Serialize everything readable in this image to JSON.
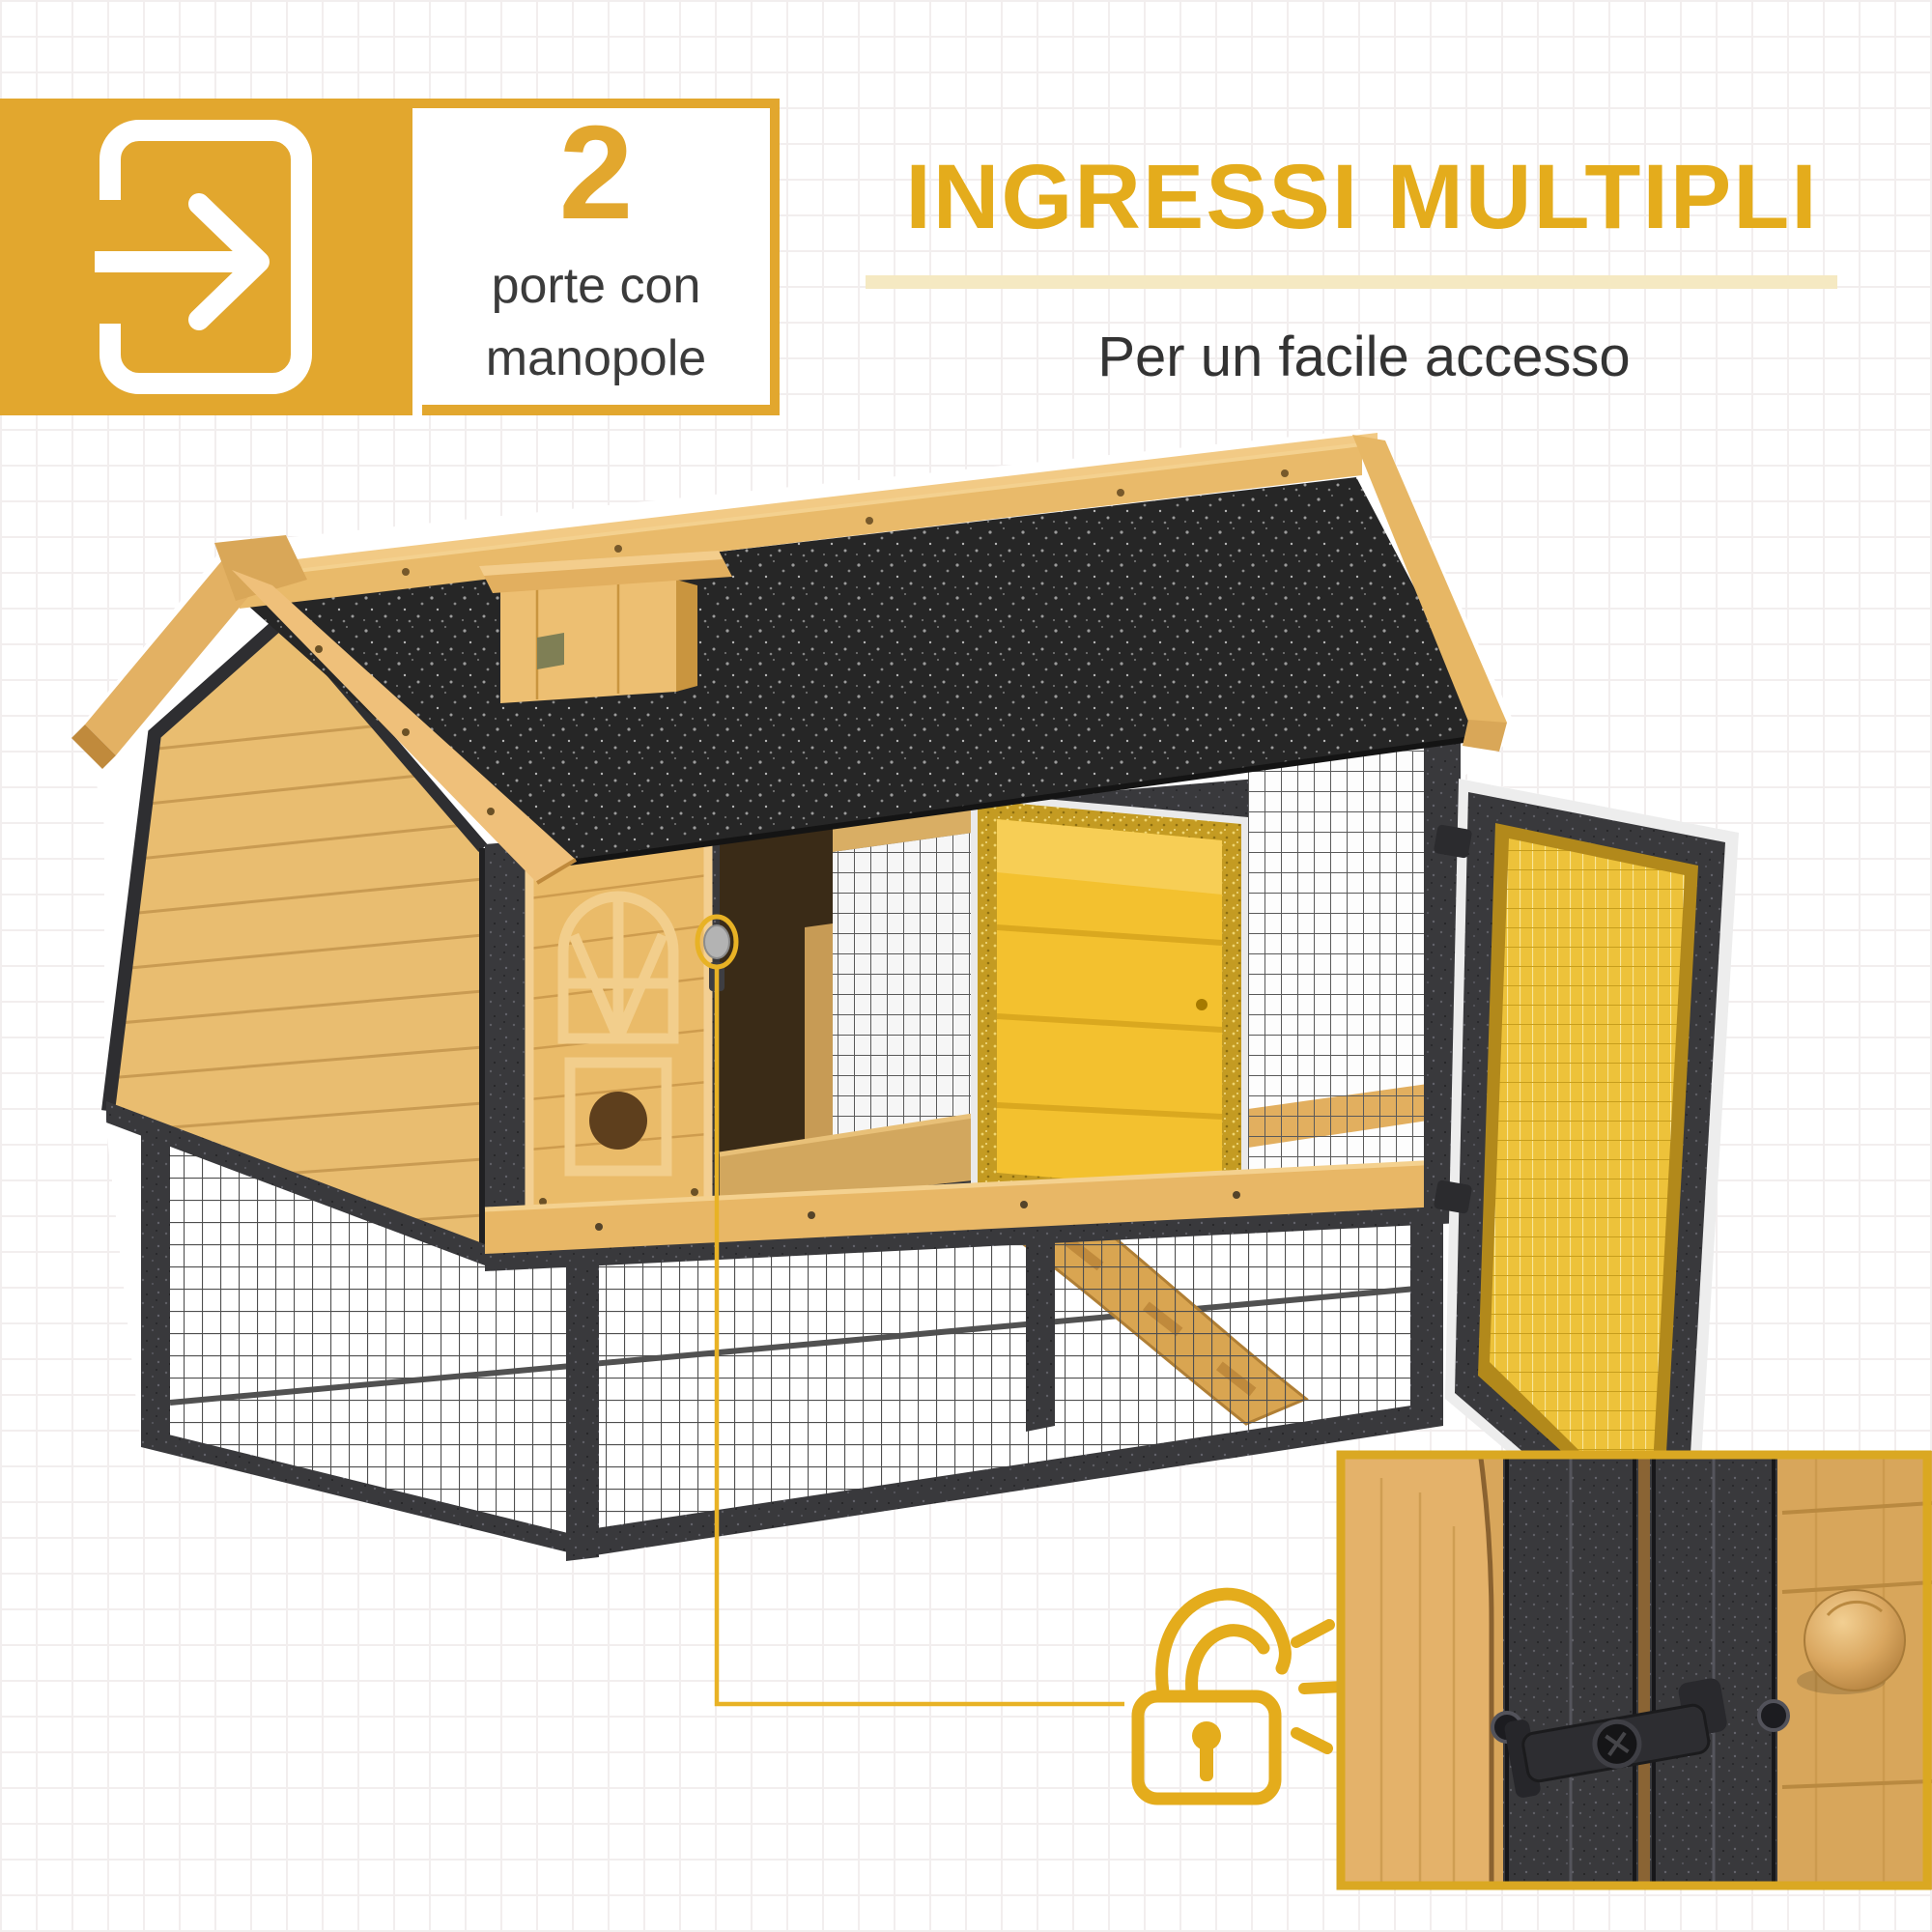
{
  "badge": {
    "number": "2",
    "caption_line1": "porte con",
    "caption_line2": "manopole",
    "icon": "door-enter-arrow-icon"
  },
  "header": {
    "title": "INGRESSI MULTIPLI",
    "subtitle": "Per un facile accesso"
  },
  "illustration": {
    "subject": "wooden chicken coop hutch with black asphalt roof, wire mesh run, ramp, highlighted yellow access door and open mesh side door",
    "callout_icon": "open-padlock-icon",
    "highlight": "door knob circled in yellow, connector line to padlock icon",
    "inset": "close-up of black metal turn latch and wooden knob on hutch door"
  },
  "colors": {
    "accent": "#E2A72E",
    "heading": "#E4AC1C",
    "underline": "#F5E9C2",
    "text_dark": "#3B3B3B",
    "subtitle": "#333333",
    "wood": "#E8B766",
    "wood_dark": "#C69146",
    "roof": "#262626",
    "metal": "#39393C",
    "mesh": "#565656",
    "highlight_door": "#F3C12F",
    "door_mesh": "#EDC23A",
    "gold_border": "#B2891B",
    "background": "#FFFFFF",
    "grid_line": "#F2EEEE"
  }
}
